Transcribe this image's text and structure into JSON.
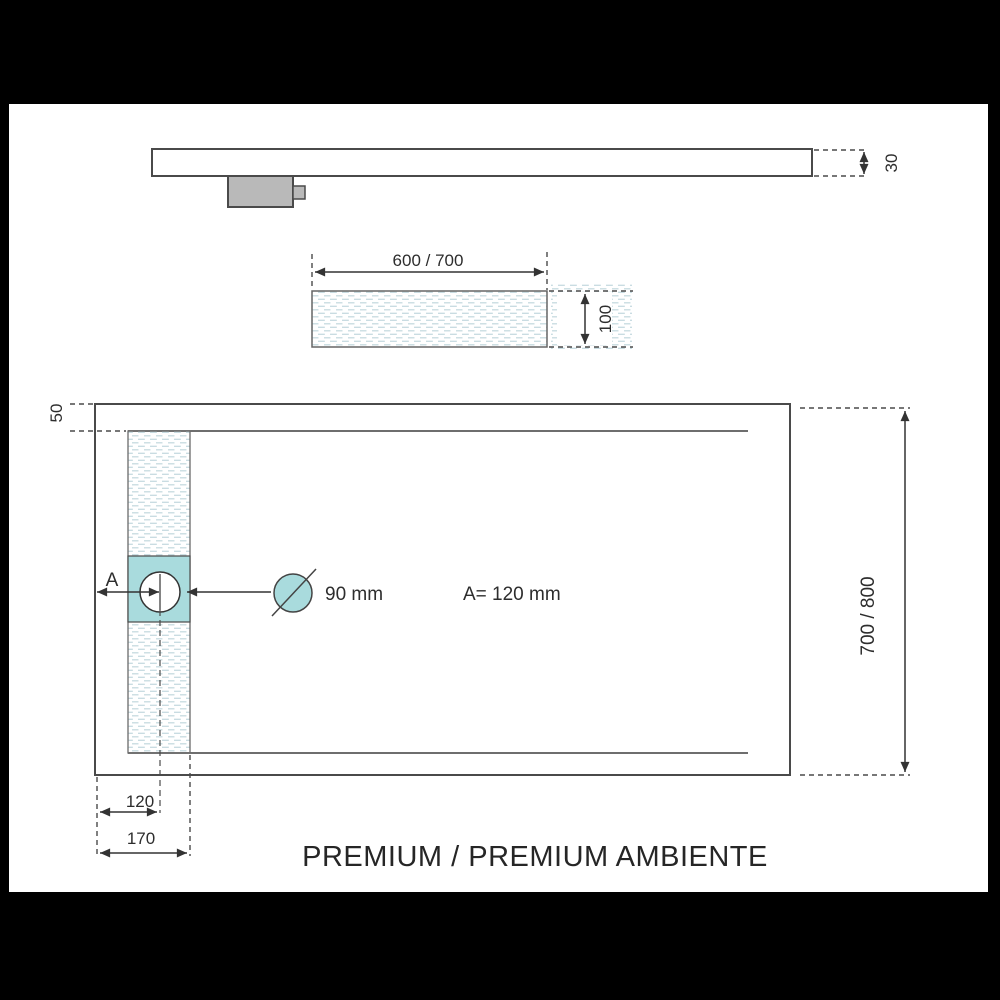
{
  "title": "PREMIUM / PREMIUM AMBIENTE",
  "side_view": {
    "thickness": "30"
  },
  "channel_view": {
    "width": "600 / 700",
    "depth": "100"
  },
  "plan_view": {
    "top_offset": "50",
    "a_label": "A",
    "drain_diameter": "90 mm",
    "a_value": "A= 120 mm",
    "length": "700 / 800",
    "drain_center_offset": "120",
    "channel_offset": "170"
  },
  "colors": {
    "accent_teal": "#a9dbdd",
    "line": "#4a4a4a",
    "hatch": "#c6dbe0",
    "drain_box_gray": "#b9b9b9",
    "frame": "#000000",
    "paper": "#ffffff"
  }
}
